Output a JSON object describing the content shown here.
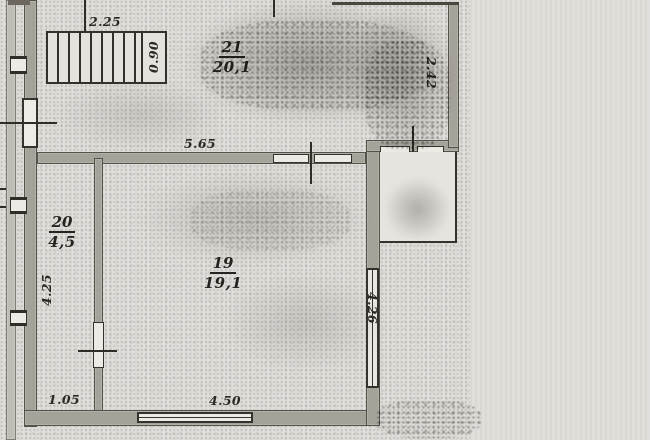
{
  "rooms": {
    "r21": {
      "number": "21",
      "area": "20,1"
    },
    "r20": {
      "number": "20",
      "area": "4,5"
    },
    "r19": {
      "number": "19",
      "area": "19,1"
    }
  },
  "dimensions": {
    "stair_run": "2.25",
    "stair_width": "0.90",
    "upper_wall": "5.65",
    "right_upper_wall": "2.42",
    "room20_depth": "4.25",
    "room20_width": "1.05",
    "bottom_window": "4.50",
    "right_lower_wall": "4.26"
  },
  "colors": {
    "paper": "#dfdeda",
    "wall_fill": "#a5a29a",
    "ink": "#2f2d28"
  }
}
